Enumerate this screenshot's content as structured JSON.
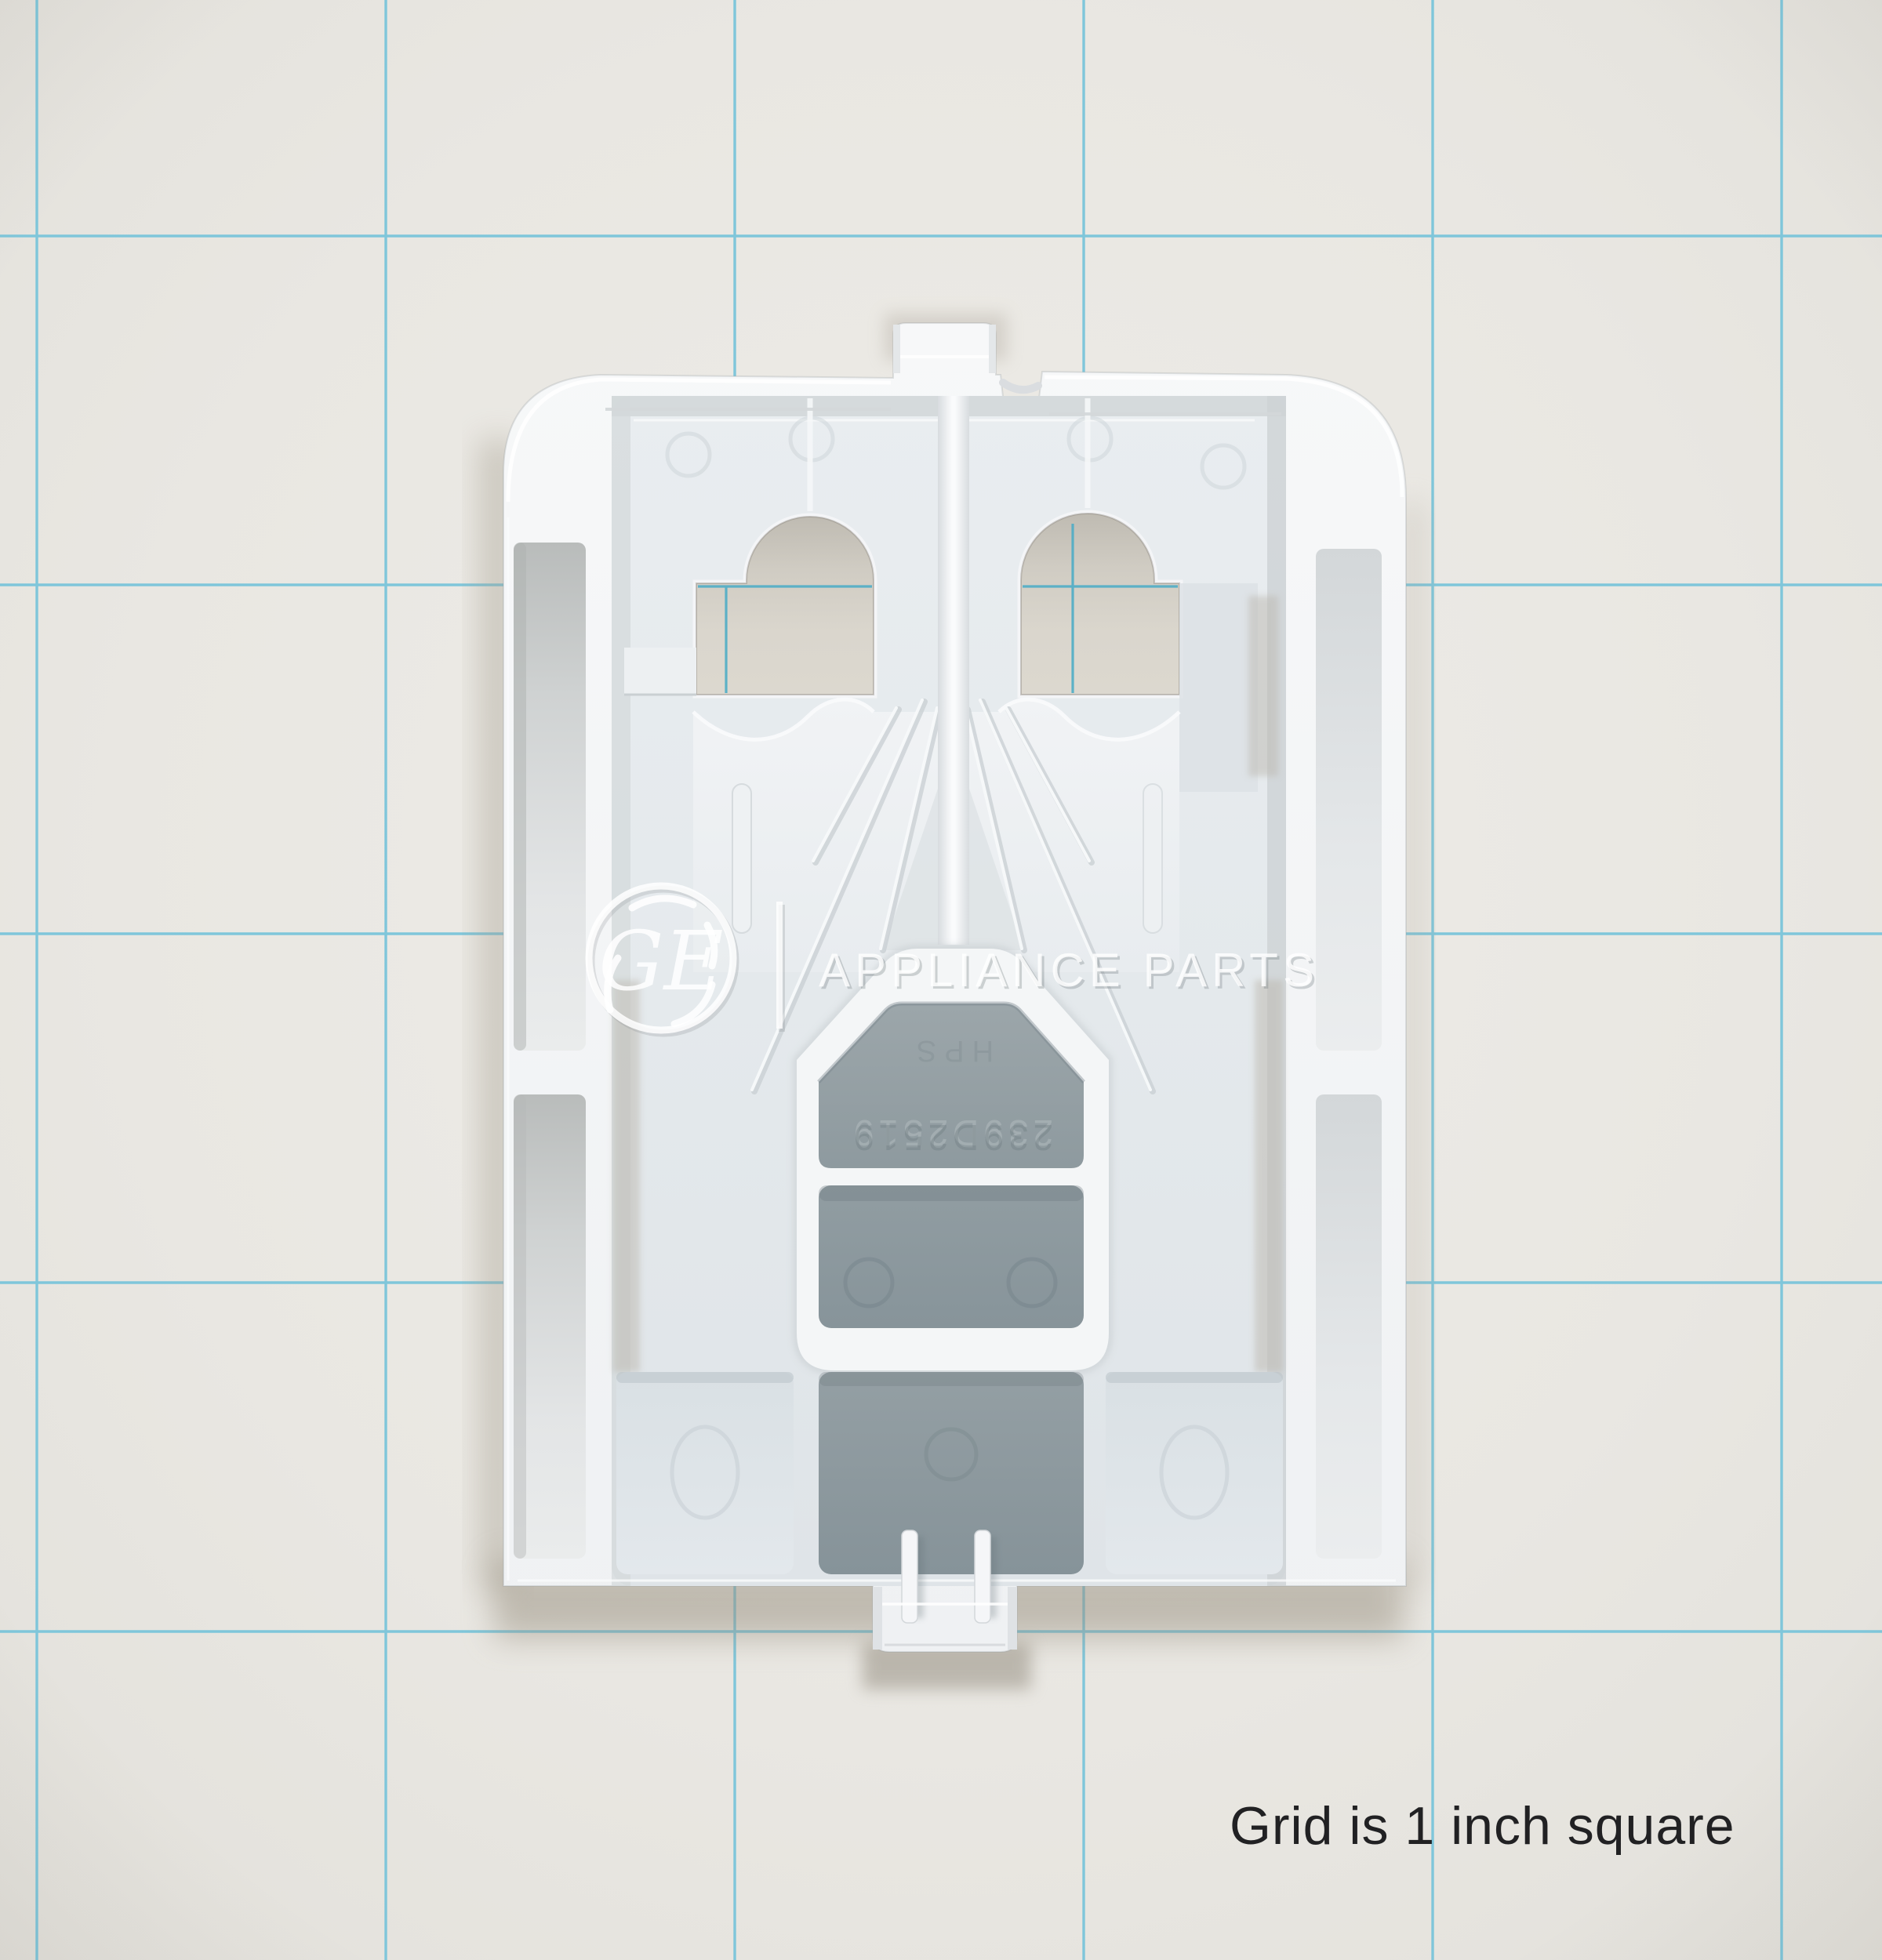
{
  "photo": {
    "caption": "Grid is 1 inch square",
    "watermark": {
      "monogram": "GE",
      "wordmark": "APPLIANCE PARTS"
    },
    "part": {
      "embossed_number": "239D2519",
      "embossed_mark": "HPS"
    },
    "grid": {
      "unit_label": "1 inch",
      "spacing_px": 445,
      "vertical_line_count": 6,
      "horizontal_line_count": 5,
      "line_color": "#74c3da"
    },
    "colors": {
      "paper": "#e9e7e2",
      "part_white": "#f4f5f7",
      "recess_gray": "#8d999e",
      "cavity_gray": "#e5e9ec",
      "shadow": "#a49d90"
    }
  }
}
